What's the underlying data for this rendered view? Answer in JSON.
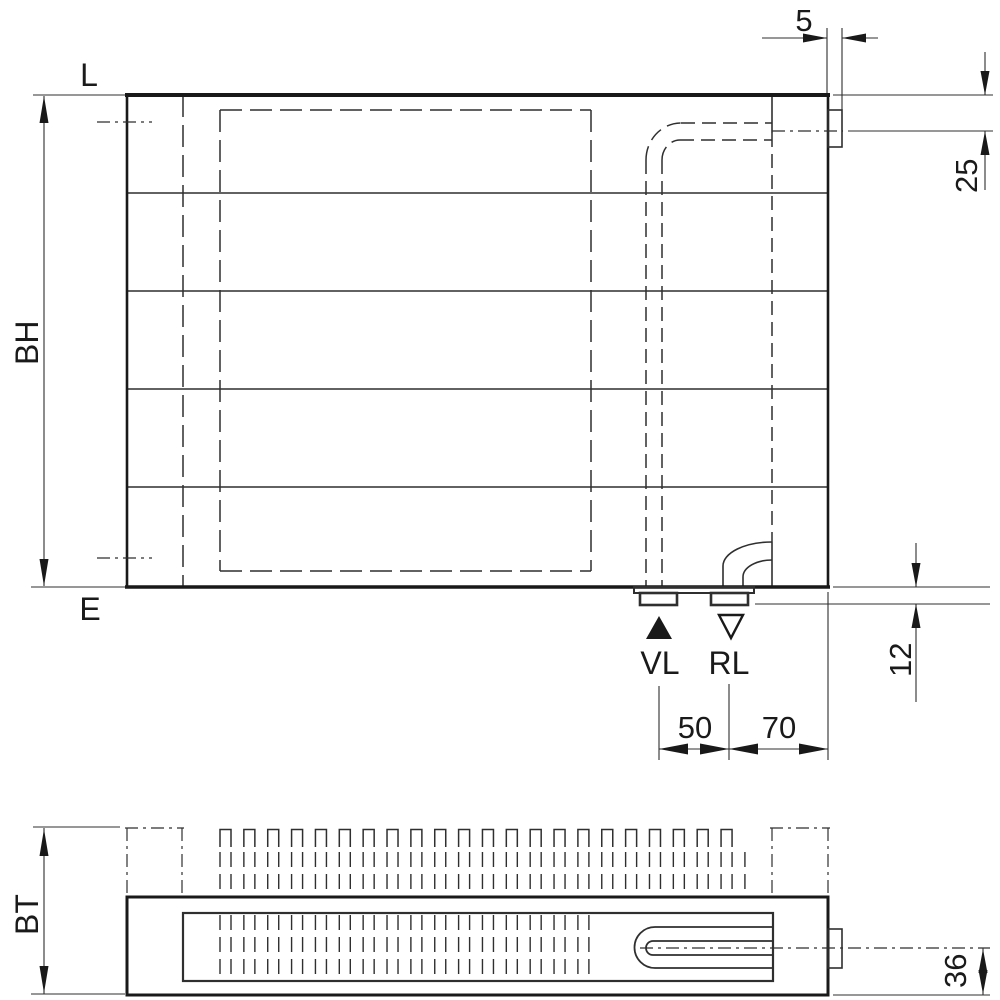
{
  "front_view": {
    "label_top_left": "L",
    "label_bottom_left": "E",
    "dim_build_height": "BH",
    "dim_tab_width": "5",
    "dim_top_connection_offset": "25",
    "dim_bottom_stub_height": "12",
    "dim_connection_spacing": "50",
    "dim_connection_to_edge": "70",
    "label_supply": "VL",
    "label_return": "RL"
  },
  "plan_view": {
    "dim_build_depth": "BT",
    "dim_channel_center_to_face": "36"
  },
  "colors": {
    "background": "#ffffff",
    "line": "#2f2f2f",
    "line_thick": "#191919",
    "text": "#1a1a1a"
  }
}
